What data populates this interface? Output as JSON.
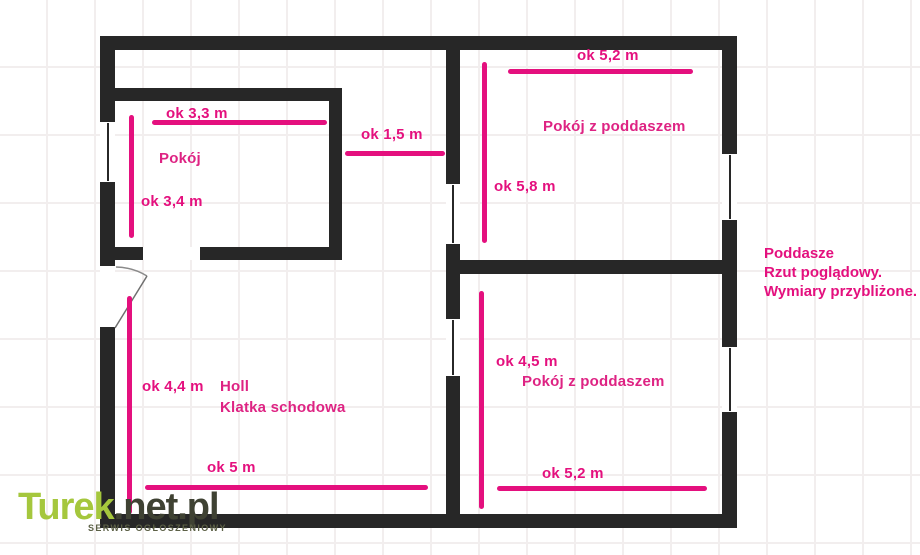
{
  "plan_title": "Poddasze",
  "annotation": {
    "line1": "Poddasze",
    "line2": "Rzut poglądowy.",
    "line3": "Wymiary przybliżone."
  },
  "rooms": {
    "pokoj": {
      "name": "Pokój",
      "top_dim": "ok 3,3 m",
      "left_dim": "ok 3,4 m"
    },
    "passage": {
      "dim": "ok 1,5 m"
    },
    "attic_room_top": {
      "name": "Pokój z poddaszem",
      "top_dim": "ok 5,2 m",
      "left_dim": "ok 5,8 m"
    },
    "hall": {
      "name_line1": "Holl",
      "name_line2": "Klatka schodowa",
      "left_dim": "ok 4,4 m",
      "bottom_dim": "ok 5 m"
    },
    "attic_room_bottom": {
      "name": "Pokój z poddaszem",
      "left_dim": "ok 4,5 m",
      "bottom_dim": "ok 5,2 m"
    }
  },
  "watermark": {
    "brand_primary": "Turek",
    "brand_suffix": ".net.pl",
    "tagline": "SERWIS OGŁOSZENIOWY"
  },
  "colors": {
    "wall": "#272727",
    "dimension_pink": "#e4107e",
    "brand_green": "#a5c73d",
    "brand_dark": "#3f4233"
  }
}
